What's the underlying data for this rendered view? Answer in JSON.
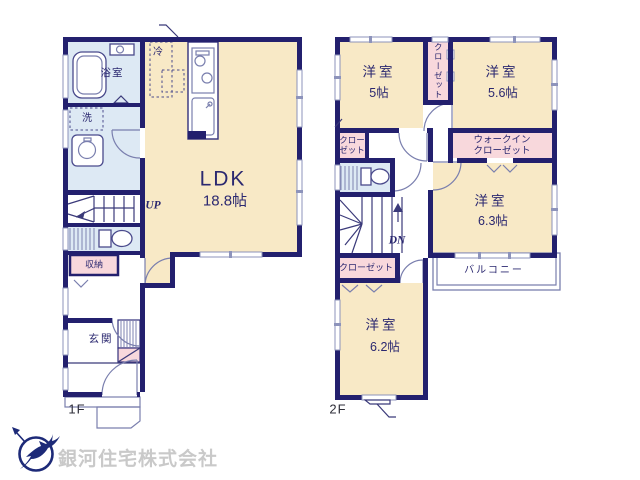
{
  "floor1": {
    "floor_label": "1F",
    "ldk_name": "LDK",
    "ldk_size": "18.8帖",
    "bathroom": "浴室",
    "laundry": "洗",
    "fridge": "冷",
    "storage": "収納",
    "entrance": "玄関",
    "stairs_up": "UP"
  },
  "floor2": {
    "floor_label": "2F",
    "bedroom1_name": "洋室",
    "bedroom1_size": "5帖",
    "bedroom2_name": "洋室",
    "bedroom2_size": "5.6帖",
    "bedroom3_name": "洋室",
    "bedroom3_size": "6.3帖",
    "bedroom4_name": "洋室",
    "bedroom4_size": "6.2帖",
    "closet_vertical": "クローゼット",
    "closet_small_line1": "クロー",
    "closet_small_line2": "ゼット",
    "walkin_line1": "ウォークイン",
    "walkin_line2": "クローゼット",
    "closet_bottom": "クローゼット",
    "balcony": "バルコニー",
    "stairs_down": "DN"
  },
  "footer": {
    "company_name": "銀河住宅株式会社"
  },
  "colors": {
    "wall_navy": "#23206e",
    "room_cream": "#f8e9c6",
    "room_blue": "#dde9f4",
    "closet_pink": "#f8d8dc",
    "watermark_gray": "#c9c9c9",
    "logo_navy": "#1d2a78"
  }
}
